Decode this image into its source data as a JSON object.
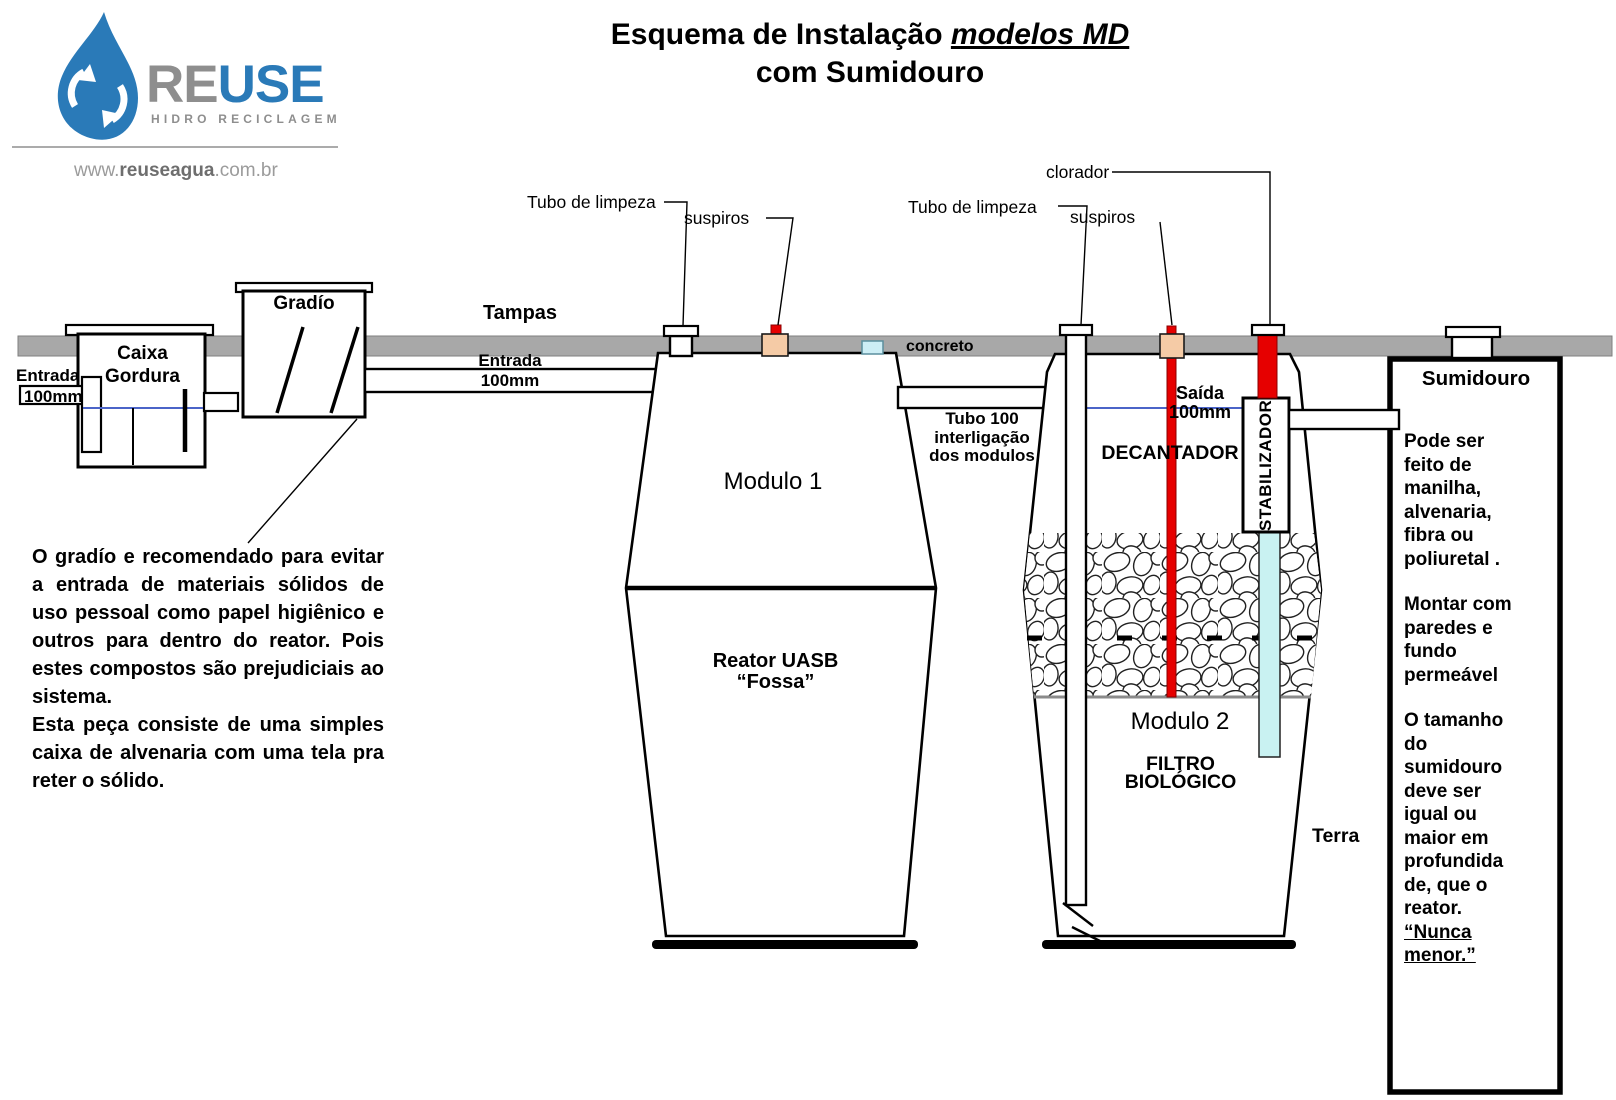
{
  "colors": {
    "c-bar": "#a8a8a8",
    "c-red": "#e60000",
    "c-peach": "#f5cba6",
    "c-cyan": "#c9f2f2",
    "c-chip": "#cdeef5",
    "c-water": "#4b64c8",
    "c-brand": "#2a7ab8",
    "c-gray-text": "#8e8e8e"
  },
  "title": {
    "l1a": "Esquema de Instalação ",
    "l1b": "modelos MD",
    "l2": "com Sumidouro"
  },
  "logo": {
    "re": "RE",
    "use": "USE",
    "tagline": "HIDRO RECICLAGEM",
    "url_www": "www.",
    "url_name": "reuseagua",
    "url_tld": ".com.br"
  },
  "labels": {
    "tampas": "Tampas",
    "concreto": "concreto",
    "terra": "Terra",
    "gradio": "Gradío",
    "clorador": "clorador",
    "tubo_limpeza_1": "Tubo de limpeza",
    "tubo_limpeza_2": "Tubo de limpeza",
    "suspiros_1": "suspiros",
    "suspiros_2": "suspiros",
    "decantador": "DECANTADOR",
    "estabilizador": "STABILIZADOR",
    "modulo1": "Modulo 1",
    "modulo2": "Modulo 2",
    "sumidouro": "Sumidouro",
    "caixa_gordura": {
      "a": "Caixa",
      "b": "Gordura"
    },
    "entrada_left": {
      "a": "Entrada",
      "b": "100mm"
    },
    "entrada_mid": {
      "a": "Entrada",
      "b": "100mm"
    },
    "saida": {
      "a": "Saída",
      "b": "100mm"
    },
    "reator": {
      "a": "Reator UASB",
      "b": "“Fossa”"
    },
    "filtro": {
      "a": "FILTRO",
      "b": "BIOLÓGICO"
    },
    "interligacao": {
      "a": "Tubo 100",
      "b": "interligação",
      "c": "dos modulos"
    }
  },
  "notes": {
    "gradio_p1": "O gradío e recomendado para evitar a entrada de materiais sólidos de uso pessoal como papel higiênico e outros para dentro do reator. Pois estes compostos são prejudiciais ao sistema.",
    "gradio_p2": "Esta peça consiste de uma simples caixa de alvenaria com uma tela pra reter o sólido.",
    "sumidouro_p1": "Pode ser feito de manilha, alvenaria, fibra ou poliuretal .",
    "sumidouro_p2": "Montar com paredes e fundo permeável",
    "sumidouro_p3": "O tamanho do sumidouro deve ser igual ou maior em profundida de, que o reator.",
    "sumidouro_p4": "“Nunca menor.”"
  }
}
